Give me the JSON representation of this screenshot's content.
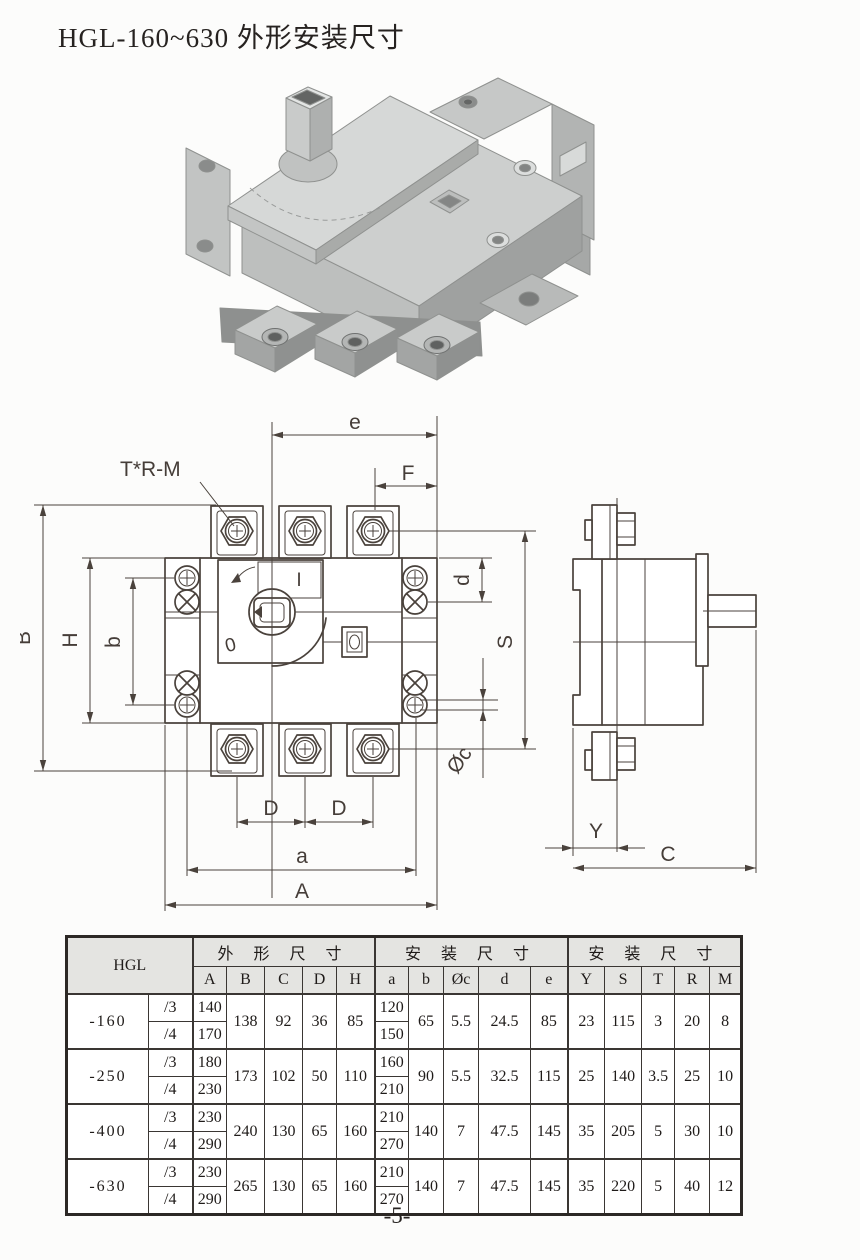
{
  "page": {
    "title": "HGL-160~630 外形安装尺寸",
    "page_number": "-5-"
  },
  "colors": {
    "line_color": "#4a423c",
    "table_header_bg": "#e4e4e1",
    "paper": "#fcfcfb",
    "iso_body_gray": "#cdcfce"
  },
  "drawing": {
    "labels": {
      "thread_callout": "T*R-M",
      "e": "e",
      "F": "F",
      "B": "B",
      "H": "H",
      "b": "b",
      "d": "d",
      "S": "S",
      "phi_c": "Øc",
      "D1": "D",
      "D2": "D",
      "a": "a",
      "A": "A",
      "Y": "Y",
      "C": "C",
      "pos_on": "I",
      "pos_off": "0"
    }
  },
  "table": {
    "corner_label": "HGL",
    "groups": [
      {
        "label": "外 形 尺 寸"
      },
      {
        "label": "安 装 尺 寸"
      },
      {
        "label": "安 装 尺 寸"
      }
    ],
    "columns": [
      "A",
      "B",
      "C",
      "D",
      "H",
      "a",
      "b",
      "Øc",
      "d",
      "e",
      "Y",
      "S",
      "T",
      "R",
      "M"
    ],
    "rows": [
      {
        "model": "-160",
        "sub": [
          {
            "variant": "/3",
            "A": "140",
            "a": "120"
          },
          {
            "variant": "/4",
            "A": "170",
            "a": "150"
          }
        ],
        "B": "138",
        "C": "92",
        "D": "36",
        "H": "85",
        "b": "65",
        "oc": "5.5",
        "d": "24.5",
        "e": "85",
        "Y": "23",
        "S": "115",
        "T": "3",
        "R": "20",
        "M": "8"
      },
      {
        "model": "-250",
        "sub": [
          {
            "variant": "/3",
            "A": "180",
            "a": "160"
          },
          {
            "variant": "/4",
            "A": "230",
            "a": "210"
          }
        ],
        "B": "173",
        "C": "102",
        "D": "50",
        "H": "110",
        "b": "90",
        "oc": "5.5",
        "d": "32.5",
        "e": "115",
        "Y": "25",
        "S": "140",
        "T": "3.5",
        "R": "25",
        "M": "10"
      },
      {
        "model": "-400",
        "sub": [
          {
            "variant": "/3",
            "A": "230",
            "a": "210"
          },
          {
            "variant": "/4",
            "A": "290",
            "a": "270"
          }
        ],
        "B": "240",
        "C": "130",
        "D": "65",
        "H": "160",
        "b": "140",
        "oc": "7",
        "d": "47.5",
        "e": "145",
        "Y": "35",
        "S": "205",
        "T": "5",
        "R": "30",
        "M": "10"
      },
      {
        "model": "-630",
        "sub": [
          {
            "variant": "/3",
            "A": "230",
            "a": "210"
          },
          {
            "variant": "/4",
            "A": "290",
            "a": "270"
          }
        ],
        "B": "265",
        "C": "130",
        "D": "65",
        "H": "160",
        "b": "140",
        "oc": "7",
        "d": "47.5",
        "e": "145",
        "Y": "35",
        "S": "220",
        "T": "5",
        "R": "40",
        "M": "12"
      }
    ]
  }
}
